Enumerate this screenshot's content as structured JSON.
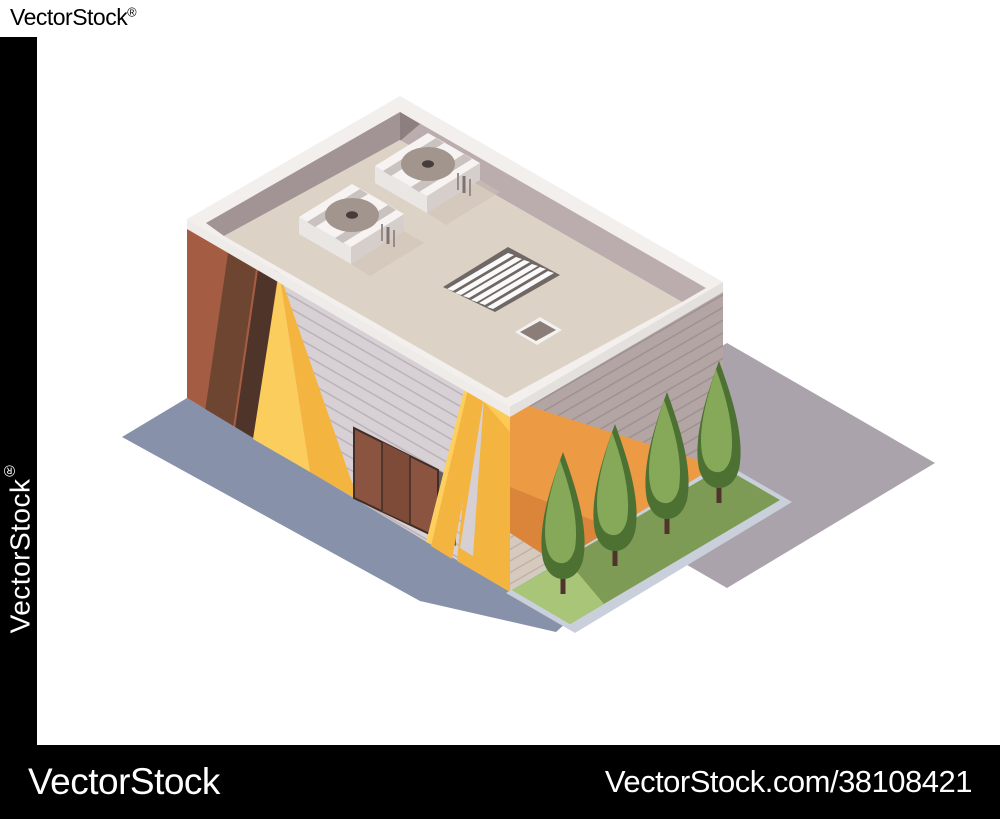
{
  "image": {
    "width": 1000,
    "height": 819,
    "background": "#ffffff",
    "description": "Isometric illustration of a modern supermarket / shop building with flat roof, rooftop AC fan units, ventilation grate and hatch, brown striped wall section, yellow chevron accents, orange wall band, a three-panel door, four cypress trees on a grass strip and gray pavement slabs"
  },
  "watermarks": {
    "logo_text": "VectorStock",
    "registered_mark": "®",
    "left_bar_text": "VectorStock",
    "bottom_bar": {
      "left_text": "VectorStock",
      "right_text": "VectorStock.com/38108421",
      "background": "#000000",
      "text_color": "#ffffff"
    }
  },
  "scene": {
    "elements": [
      "right-pavement-slab",
      "left-pavement-slab",
      "front-wall",
      "side-wall",
      "brown-wall-section",
      "yellow-wedge",
      "door",
      "yellow-chevron",
      "orange-band",
      "tan-corner",
      "roof-parapet",
      "roof-deck",
      "ac-unit-1",
      "ac-unit-2",
      "roof-grate",
      "roof-hatch",
      "grass-strip",
      "curb",
      "tree-1",
      "tree-2",
      "tree-3",
      "tree-4"
    ],
    "palette": {
      "roof_deck": "#ddd2c6",
      "parapet_rim": "#f2efed",
      "parapet_inner_dark": "#a29395",
      "parapet_inner_light": "#bbadae",
      "wall_front": "#d7d1d5",
      "wall_side": "#b2a5a4",
      "accent_brown": "#a45c42",
      "accent_brown_mid": "#6e4531",
      "accent_brown_dark": "#4f342a",
      "accent_yellow": "#f4b440",
      "accent_yellow_light": "#fccf5e",
      "accent_orange": "#ec9a44",
      "accent_orange_dark": "#db853b",
      "door": "#8a5440",
      "tree_dark": "#4d7133",
      "tree_light": "#85a958",
      "trunk": "#4e342c",
      "grass": "#7e9b55",
      "grass_light": "#a9c678",
      "curb": "#c9d0db",
      "pavement_left": "#8791a9",
      "pavement_right": "#aba3ab",
      "ac_fan": "#a1958e",
      "watermark_bg": "#000000"
    }
  }
}
